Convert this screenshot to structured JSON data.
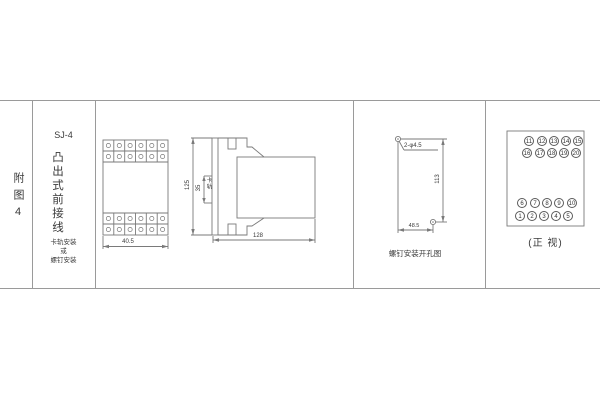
{
  "sheet": {
    "figure_label": "附图4",
    "model": "SJ-4",
    "relay_type": "凸出式前接线",
    "mount_note": [
      "卡轨安装",
      "或",
      "螺钉安装"
    ]
  },
  "front_view": {
    "width_dim": "40.5"
  },
  "side_view": {
    "height_dim": "125",
    "rail_span_dim": "35",
    "rail_label": "卡轨",
    "depth_dim": "128"
  },
  "drill_view": {
    "holes_label": "2-φ4.5",
    "vertical_dim": "113",
    "horizontal_dim": "48.5",
    "caption": "螺钉安装开孔图"
  },
  "terminal_view": {
    "rows_top": [
      [
        "11",
        "12",
        "13",
        "14",
        "15"
      ],
      [
        "16",
        "17",
        "18",
        "19",
        "20"
      ]
    ],
    "rows_bottom": [
      [
        "6",
        "7",
        "8",
        "9",
        "10"
      ],
      [
        "1",
        "2",
        "3",
        "4",
        "5"
      ]
    ],
    "caption": "(正 视)"
  },
  "colors": {
    "line": "#7a7a7a",
    "frame": "#9a9a9a",
    "text": "#3a3a3a"
  }
}
